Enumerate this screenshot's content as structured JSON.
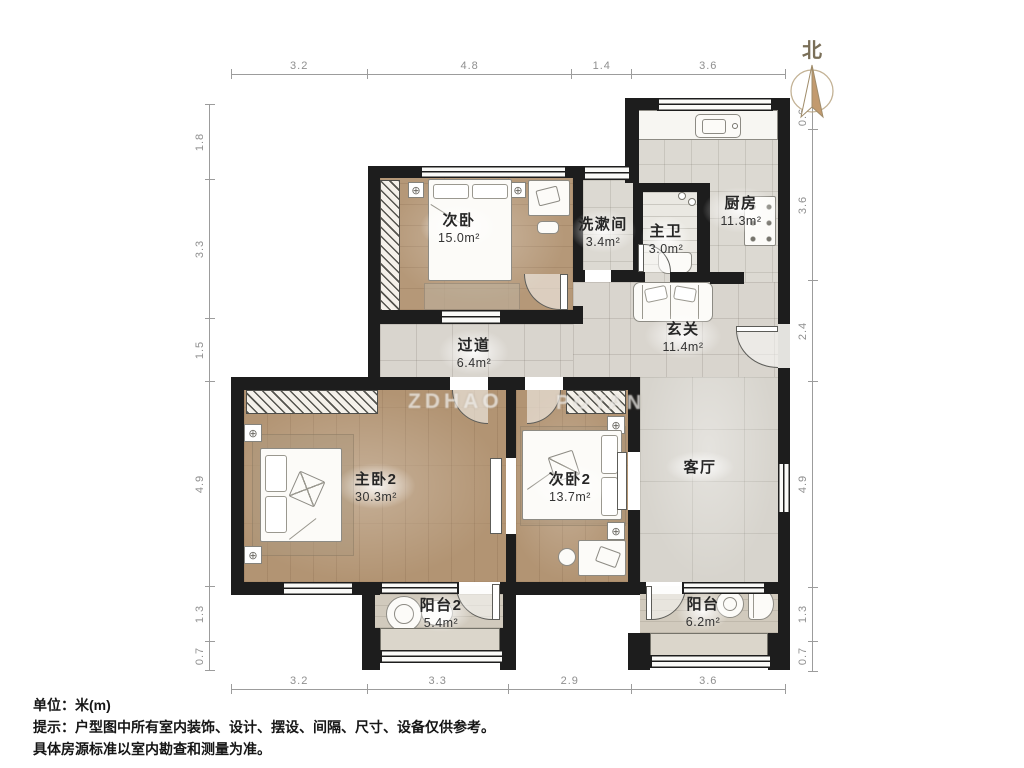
{
  "north": {
    "label": "北"
  },
  "icons": {
    "lamp": "⊕"
  },
  "dimensions": {
    "top": [
      "3.2",
      "4.8",
      "1.4",
      "3.6"
    ],
    "bottom": [
      "3.2",
      "3.3",
      "2.9",
      "3.6"
    ],
    "left": [
      "1.8",
      "3.3",
      "1.5",
      "4.9",
      "1.3",
      "0.7"
    ],
    "right": [
      "0.6",
      "3.6",
      "2.4",
      "4.9",
      "1.3",
      "0.7"
    ]
  },
  "rooms": [
    {
      "name": "次卧",
      "area": "15.0m²"
    },
    {
      "name": "洗漱间",
      "area": "3.4m²"
    },
    {
      "name": "主卫",
      "area": "3.0m²"
    },
    {
      "name": "厨房",
      "area": "11.3m²"
    },
    {
      "name": "过道",
      "area": "6.4m²"
    },
    {
      "name": "玄关",
      "area": "11.4m²"
    },
    {
      "name": "主卧2",
      "area": "30.3m²"
    },
    {
      "name": "次卧2",
      "area": "13.7m²"
    },
    {
      "name": "客厅",
      "area": ""
    },
    {
      "name": "阳台2",
      "area": "5.4m²"
    },
    {
      "name": "阳台",
      "area": "6.2m²"
    }
  ],
  "watermark": {
    "fragments": [
      "ZDHAO",
      "POYAN"
    ]
  },
  "footer": {
    "unit": "单位：米(m)",
    "note1": "提示：户型图中所有室内装饰、设计、摆设、间隔、尺寸、设备仅供参考。",
    "note2": "具体房源标准以室内勘查和测量为准。"
  },
  "colors": {
    "wall": "#1d1d1d",
    "wood": "#b59878",
    "tile": "#d9d5ce",
    "balcony": "#d1cabd",
    "dim_text": "#8f8f8f",
    "label_text": "#262626",
    "compass": "#c29a6e"
  }
}
